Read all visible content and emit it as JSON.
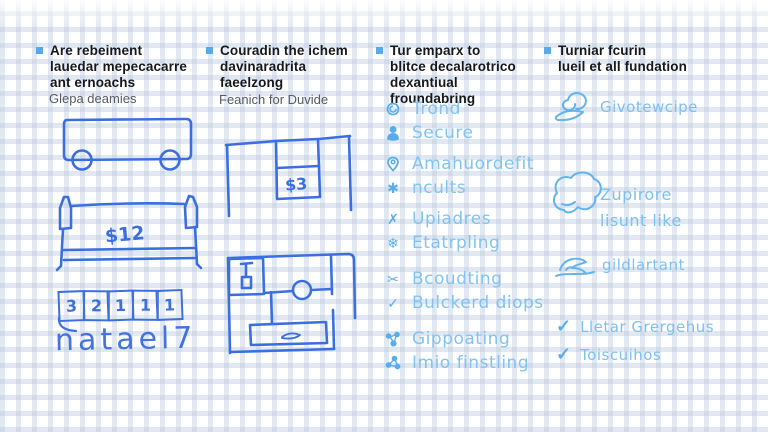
{
  "background": {
    "pattern": "grid-paper",
    "grid_color": "#bac9dd",
    "base_color": "#ffffff"
  },
  "accent": {
    "bullet": "#58a9e9",
    "sketch_blue": "#3b6fe0",
    "hand_blue_light": "#7fc4f2",
    "header_text": "#15181c",
    "subtitle_text": "#555b63"
  },
  "glyphs": {
    "asterisk": "✱",
    "x": "✗",
    "snowflake": "❄",
    "scissors": "✂",
    "check": "✓"
  },
  "columns": [
    {
      "header": "Are rebeiment\nlauedar mepecacarre\nant ernoachs",
      "subtitle": "Glepa deamies",
      "sketches": {
        "price_label": "$12",
        "strip_cells": [
          "3",
          "2",
          "1",
          "1",
          "1"
        ],
        "caption": "natael7"
      }
    },
    {
      "header": "Couradin the ichem\ndavinaradrita\nfaeelzong",
      "subtitle": "Feanich for Duvide",
      "sketches": {
        "price_label": "$3"
      }
    },
    {
      "header": "Tur emparx to\nblitce decalarotrico\ndexantiual froundabring",
      "items": [
        {
          "icon": "coin-icon",
          "label": "Trond"
        },
        {
          "icon": "person-icon",
          "label": "Secure"
        },
        {
          "icon": "pin-icon",
          "label": "Amahuordefit"
        },
        {
          "icon": "asterisk-icon",
          "label": "ncults"
        },
        {
          "icon": "x-icon",
          "label": "Upiadres"
        },
        {
          "icon": "snowflake-icon",
          "label": "Etatrpling"
        },
        {
          "icon": "scissors-icon",
          "label": "Bcoudting"
        },
        {
          "icon": "check-icon",
          "label": "Bulckerd diops"
        },
        {
          "icon": "share-nodes-icon",
          "label": "Gippoating"
        },
        {
          "icon": "share-nodes-icon",
          "label": "Imio finstling"
        }
      ]
    },
    {
      "header": "Turniar fcurin\nlueil et all fundation",
      "items": [
        {
          "icon": "swirl-doodle-icon",
          "label": "Givotewcipe"
        },
        {
          "icon": "cloud-doodle-icon",
          "label": "Zupirore\nlisunt like"
        },
        {
          "icon": "bird-doodle-icon",
          "label": "gildlartant"
        },
        {
          "icon": "check-icon",
          "label": "Lletar Grergehus"
        },
        {
          "icon": "check-icon",
          "label": "Toiscuihos"
        }
      ]
    }
  ]
}
